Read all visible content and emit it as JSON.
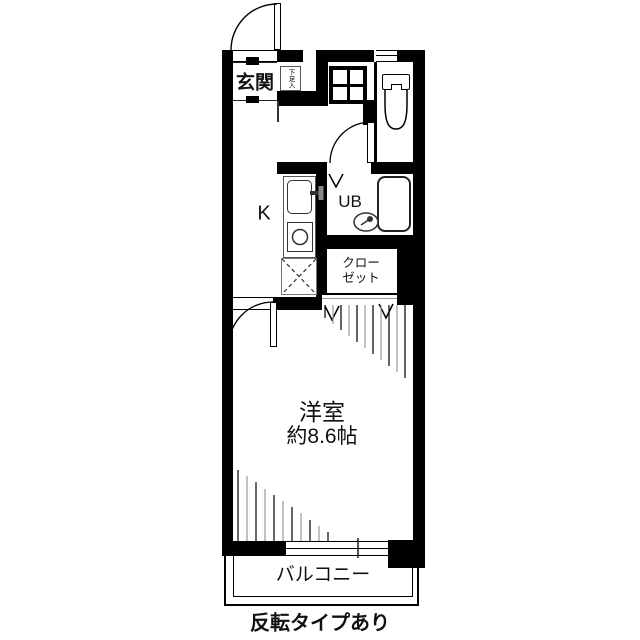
{
  "plan": {
    "entrance_label": "玄関",
    "shoe_cabinet_label": "下足入",
    "kitchen_label": "K",
    "unit_bath_label": "UB",
    "closet_label_line1": "クロー",
    "closet_label_line2": "ゼット",
    "room_label": "洋室",
    "room_size_label": "約8.6帖",
    "balcony_label": "バルコニー",
    "note_label": "反転タイプあり"
  },
  "colors": {
    "wall": "#000000",
    "background": "#ffffff",
    "fixture_line": "#333333",
    "hatch_alt": "#999999"
  }
}
